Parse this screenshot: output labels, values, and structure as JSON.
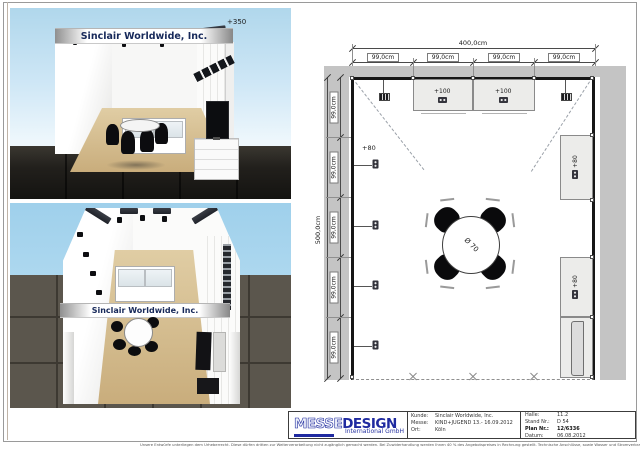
{
  "renders": {
    "front_view": {
      "fascia_text": "Sinclair Worldwide, Inc.",
      "height_label": "+350"
    },
    "top_view": {
      "fascia_text": "Sinclair Worldwide, Inc."
    }
  },
  "plan": {
    "width_total": "400,0cm",
    "depth_total": "500,0cm",
    "top_segments": [
      "99,0cm",
      "99,0cm",
      "99,0cm",
      "99,0cm"
    ],
    "left_segments": [
      "99,0cm",
      "99,0cm",
      "99,0cm",
      "99,0cm",
      "99,0cm"
    ],
    "cabinets_top": [
      {
        "height_label": "+100"
      },
      {
        "height_label": "+100"
      }
    ],
    "cabinets_right": [
      {
        "height_label": "+80"
      },
      {
        "height_label": "+80"
      }
    ],
    "left_wall_height_label": "+80",
    "table": {
      "diameter_label": "Ø 70"
    }
  },
  "title_block": {
    "logo": {
      "word_outline": "MESSE",
      "word_solid": "DESIGN",
      "subtitle": "International GmbH"
    },
    "fields_left": [
      {
        "label": "Kunde:",
        "value": "Sinclair Worldwide, Inc."
      },
      {
        "label": "Messe:",
        "value": "KIND+JUGEND 13.- 16.09.2012"
      },
      {
        "label": "Ort:",
        "value": "Köln"
      }
    ],
    "fields_right": [
      {
        "label": "Halle:",
        "value": "11.2"
      },
      {
        "label": "Stand Nr.:",
        "value": "D 54"
      },
      {
        "label": "Plan Nr.:",
        "value": "12/6336"
      },
      {
        "label": "Datum:",
        "value": "06.08.2012"
      }
    ]
  },
  "footer": {
    "disclaimer": "Unsere Entwürfe unterliegen dem Urheberrecht. Diese dürfen dritten zur Weiterverarbeitung nicht zugänglich gemacht werden. Bei Zuwiderhandlung werden Ihnen 40 % des Angebotspreises in Rechnung gestellt. Technische Anschlüsse, sowie Wasser und Stromverbrauch sind nicht im Preis enthalten. Eingezeichnete Dekorationen und Gegenstände die nicht in der Leistungsbeschreibung enthalten sind, gehören nicht zum Lieferumfang. Änderungen durch die Messe bleiben vorbehalten."
  },
  "colors": {
    "accent_navy": "#1f2aa0",
    "fascia_text_navy": "#17295a",
    "aisle_gray": "#c4c4c4",
    "wall_black": "#161616",
    "cabinet_fill": "#ececea",
    "wood_floor": "#d5bf94",
    "sky_blue": "#9fd0eb",
    "dark_floor": "#23211d"
  }
}
